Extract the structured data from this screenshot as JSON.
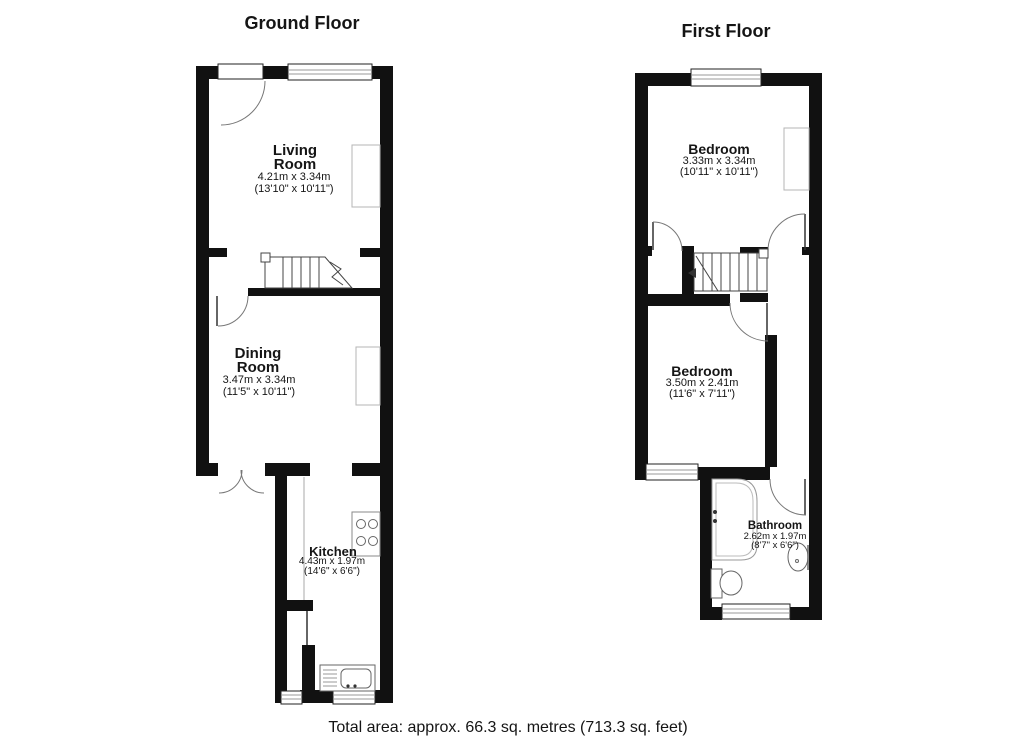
{
  "ground_floor": {
    "title": "Ground Floor",
    "rooms": {
      "living": {
        "name": "Living Room",
        "metric": "4.21m x 3.34m",
        "imperial": "(13'10\" x 10'11\")"
      },
      "dining": {
        "name": "Dining Room",
        "metric": "3.47m x 3.34m",
        "imperial": "(11'5\" x 10'11\")"
      },
      "kitchen": {
        "name": "Kitchen",
        "metric": "4.43m x 1.97m",
        "imperial": "(14'6\" x 6'6\")"
      }
    }
  },
  "first_floor": {
    "title": "First Floor",
    "rooms": {
      "bedroom1": {
        "name": "Bedroom",
        "metric": "3.33m x 3.34m",
        "imperial": "(10'11\" x 10'11\")"
      },
      "bedroom2": {
        "name": "Bedroom",
        "metric": "3.50m x 2.41m",
        "imperial": "(11'6\" x 7'11\")"
      },
      "bathroom": {
        "name": "Bathroom",
        "metric": "2.62m x 1.97m",
        "imperial": "(8'7\" x 6'6\")"
      }
    }
  },
  "footer": {
    "total_area": "Total area: approx. 66.3 sq. metres (713.3 sq. feet)"
  },
  "colors": {
    "wall": "#111111",
    "stair_line": "#444444",
    "door_arc": "#777777",
    "furniture_outline": "#b5b5b5",
    "fixture_outline": "#666666"
  }
}
